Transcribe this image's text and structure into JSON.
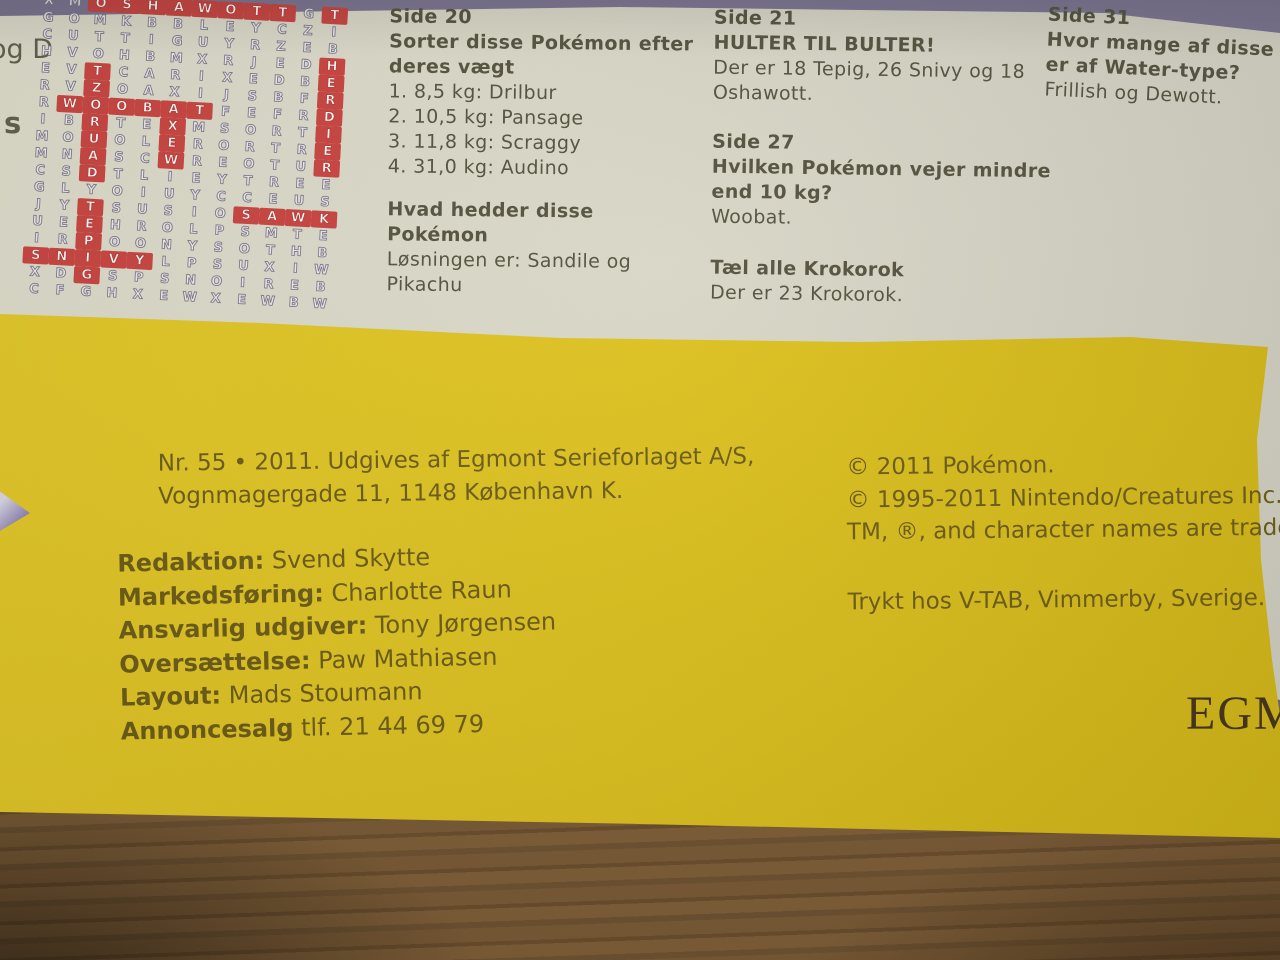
{
  "photo": {
    "colors": {
      "background_purple": "#6e6680",
      "pale_page": "#d8d6c6",
      "yellow_page": "#dcc01c",
      "highlight_red": "#c8423e",
      "grid_letter_outline": "#7d7892",
      "pale_text": "#53513d",
      "yellow_text": "#6b5b16",
      "wood_floor": "#75562f",
      "logo_brown": "#46331a"
    },
    "margin_fragments": {
      "top": "og D",
      "bottom": "s"
    },
    "wordsearch": {
      "found_words": [
        "OSHAWOTT",
        "HERDIER",
        "WOOBAT",
        "ZORUA",
        "AXEW",
        "SAWK",
        "TEPIG",
        "SNIVY"
      ],
      "rows": [
        "XMOSHAWOTTGT",
        "GOMKBBLEYCZI",
        "CUTTIGUYRZEB",
        "HVOHBMXRJEDH",
        "EVTCARIXEDBE",
        "RVZOAXIJSBFR",
        "RWOOBATFEFRD",
        "IBRTEXMSORTI",
        "MOUOLERORTRE",
        "MNASCWREOTUR",
        "CSDTLIEYTREE",
        "GLYOIUYCCEUS",
        "JYTSUSIOSAWK",
        "UEEHROLPSMTE",
        "IRPOONYSOTHB",
        "SNIVYLPSUXIW",
        "XDGSPSNOIREB",
        "CFGHXEWXEWBW"
      ],
      "highlight_mask": [
        "..########.#",
        "............",
        "............",
        "...........#",
        "..#........#",
        "..#........#",
        ".######....#",
        "..#..#.....#",
        "..#..#.....#",
        "..#..#.....#",
        "..#.........",
        "............",
        "..#.....####",
        "..#.........",
        "..#.........",
        "#####.......",
        "..#.........",
        "............"
      ]
    },
    "solutions": {
      "side20": {
        "title": "Side 20",
        "task": "Sorter disse Pokémon efter deres vægt",
        "answers": [
          "1. 8,5 kg: Drilbur",
          "2. 10,5 kg: Pansage",
          "3. 11,8 kg: Scraggy",
          "4. 31,0 kg: Audino"
        ]
      },
      "name_quiz": {
        "task": "Hvad hedder disse Pokémon",
        "answer": "Løsningen er: Sandile og Pikachu"
      },
      "side21": {
        "title": "Side 21",
        "task": "HULTER TIL BULTER!",
        "answer": "Der er 18 Tepig, 26 Snivy og 18 Oshawott."
      },
      "side27": {
        "title": "Side 27",
        "task": "Hvilken Pokémon vejer mindre end 10 kg?",
        "answer": "Woobat."
      },
      "count_quiz": {
        "task": "Tæl alle Krokorok",
        "answer": "Der er 23 Krokorok."
      },
      "side31": {
        "title": "Side 31",
        "task_line1": "Hvor mange af disse Po",
        "task_line2": "er af Water-type?",
        "answer": "Frillish og Dewott."
      }
    },
    "colophon": {
      "issue_line1": "Nr. 55 • 2011. Udgives af Egmont Serieforlaget A/S,",
      "issue_line2": "Vognmagergade 11, 1148 København K.",
      "credits": [
        {
          "label": "Redaktion:",
          "value": "Svend Skytte"
        },
        {
          "label": "Markedsføring:",
          "value": "Charlotte Raun"
        },
        {
          "label": "Ansvarlig udgiver:",
          "value": "Tony Jørgensen"
        },
        {
          "label": "Oversættelse:",
          "value": "Paw Mathiasen"
        },
        {
          "label": "Layout:",
          "value": "Mads Stoumann"
        },
        {
          "label": "Annoncesalg",
          "value": "tlf. 21 44 69 79"
        }
      ],
      "copyright_line1": "© 2011 Pokémon.",
      "copyright_line2": "© 1995-2011 Nintendo/Creatures Inc./G",
      "copyright_line3": "TM, ®, and character names are trade",
      "printer_line": "Trykt hos V-TAB, Vimmerby, Sverige.",
      "publisher_logo": "EGM"
    }
  }
}
